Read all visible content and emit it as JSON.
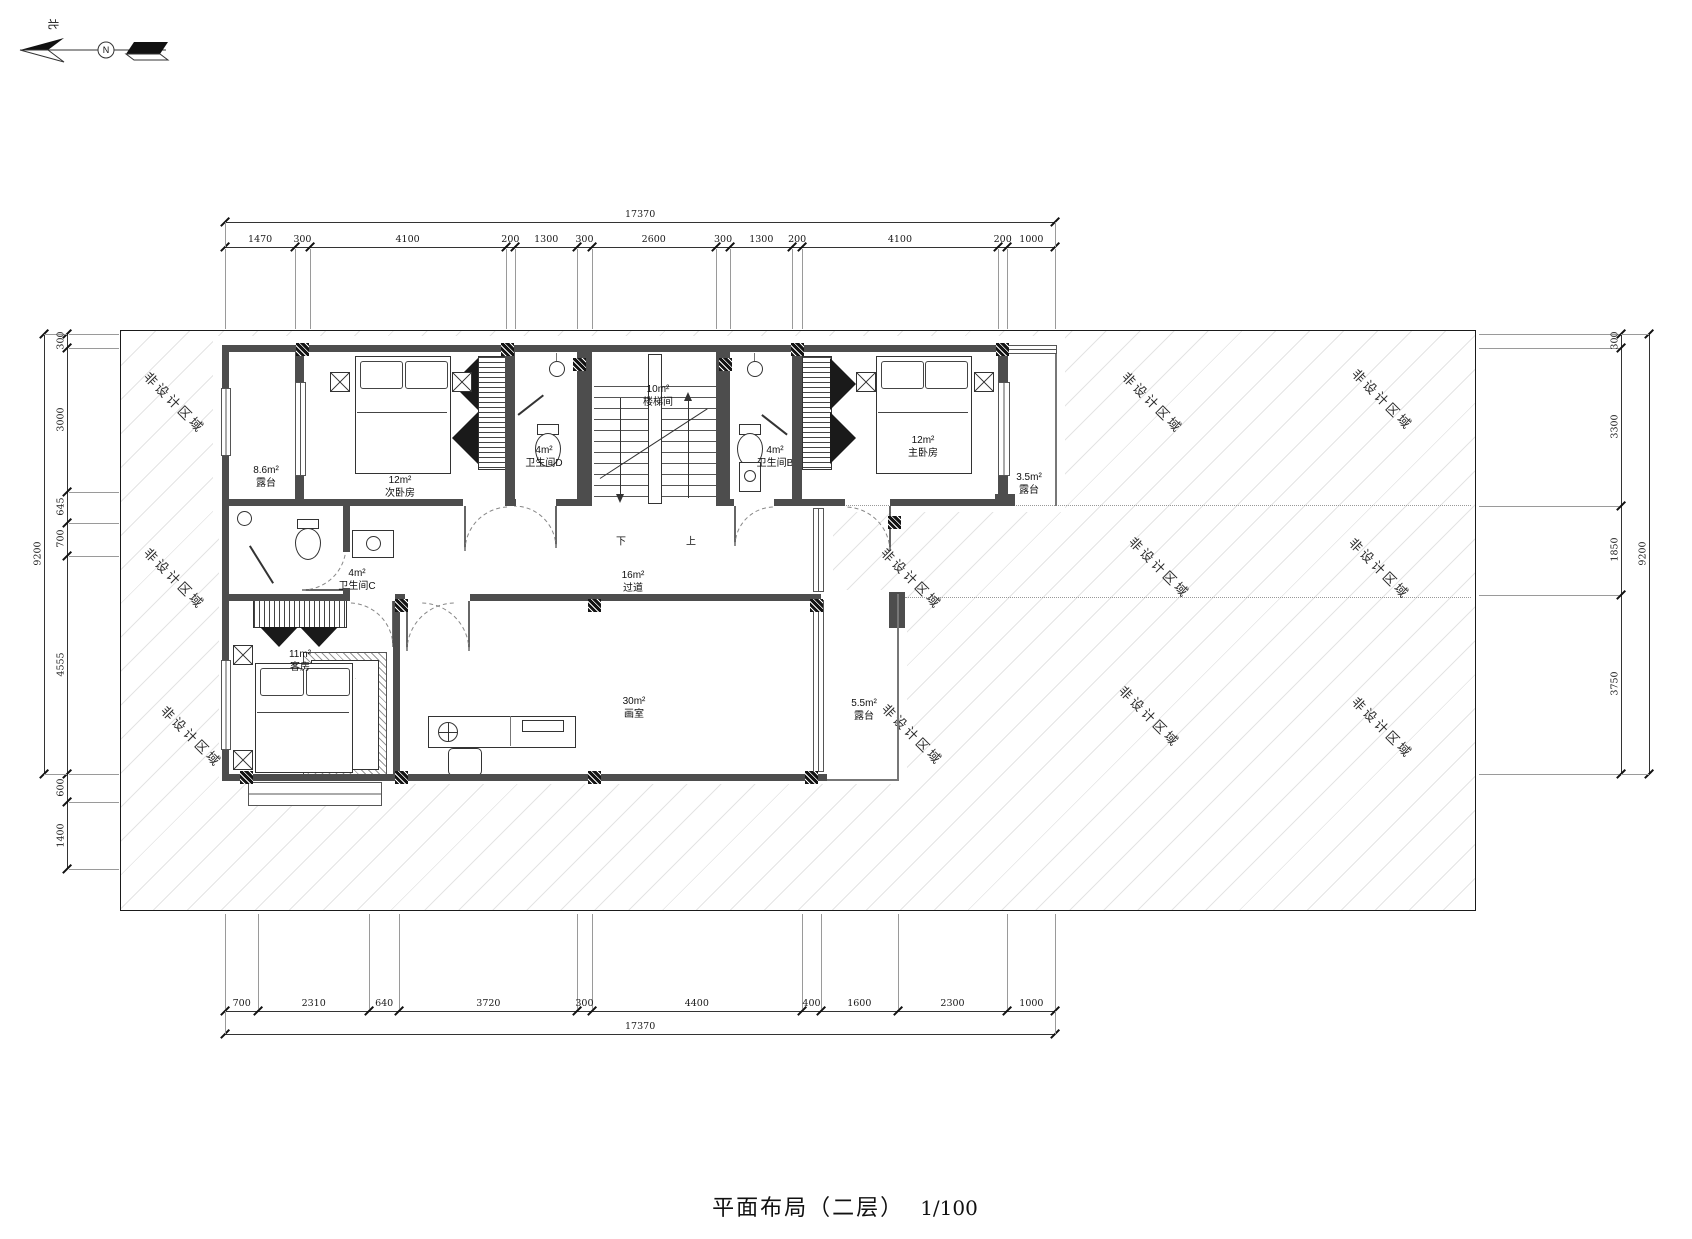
{
  "title_block": {
    "title": "平面布局（二层）",
    "scale": "1/100"
  },
  "north": {
    "label": "北",
    "letter": "N"
  },
  "non_design_label": "非设计区域",
  "stairs": {
    "down": "下",
    "up": "上"
  },
  "rooms": [
    {
      "area": "8.6m²",
      "name": "露台"
    },
    {
      "area": "12m²",
      "name": "次卧房"
    },
    {
      "area": "4m²",
      "name": "卫生间D"
    },
    {
      "area": "10m²",
      "name": "楼梯间"
    },
    {
      "area": "4m²",
      "name": "卫生间B"
    },
    {
      "area": "12m²",
      "name": "主卧房"
    },
    {
      "area": "3.5m²",
      "name": "露台"
    },
    {
      "area": "4m²",
      "name": "卫生间C"
    },
    {
      "area": "16m²",
      "name": "过道"
    },
    {
      "area": "11m²",
      "name": "客房"
    },
    {
      "area": "30m²",
      "name": "画室"
    },
    {
      "area": "5.5m²",
      "name": "露台"
    }
  ],
  "dimensions": {
    "top": {
      "total": "17370",
      "segments": [
        "1470",
        "300",
        "4100",
        "200",
        "1300",
        "300",
        "2600",
        "300",
        "1300",
        "200",
        "4100",
        "200",
        "1000"
      ]
    },
    "bottom": {
      "total": "17370",
      "segments": [
        "700",
        "2310",
        "640",
        "3720",
        "300",
        "4400",
        "400",
        "1600",
        "2300",
        "1000"
      ]
    },
    "left": {
      "total": "9200",
      "segments": [
        "300",
        "3000",
        "645",
        "700",
        "4555",
        "600",
        "1400"
      ]
    },
    "right": {
      "total": "9200",
      "segments": [
        "300",
        "3300",
        "1850",
        "3750"
      ]
    }
  },
  "colors": {
    "wall": "#4d4d4d",
    "line": "#333333",
    "hatch": "#e4e4e4"
  }
}
